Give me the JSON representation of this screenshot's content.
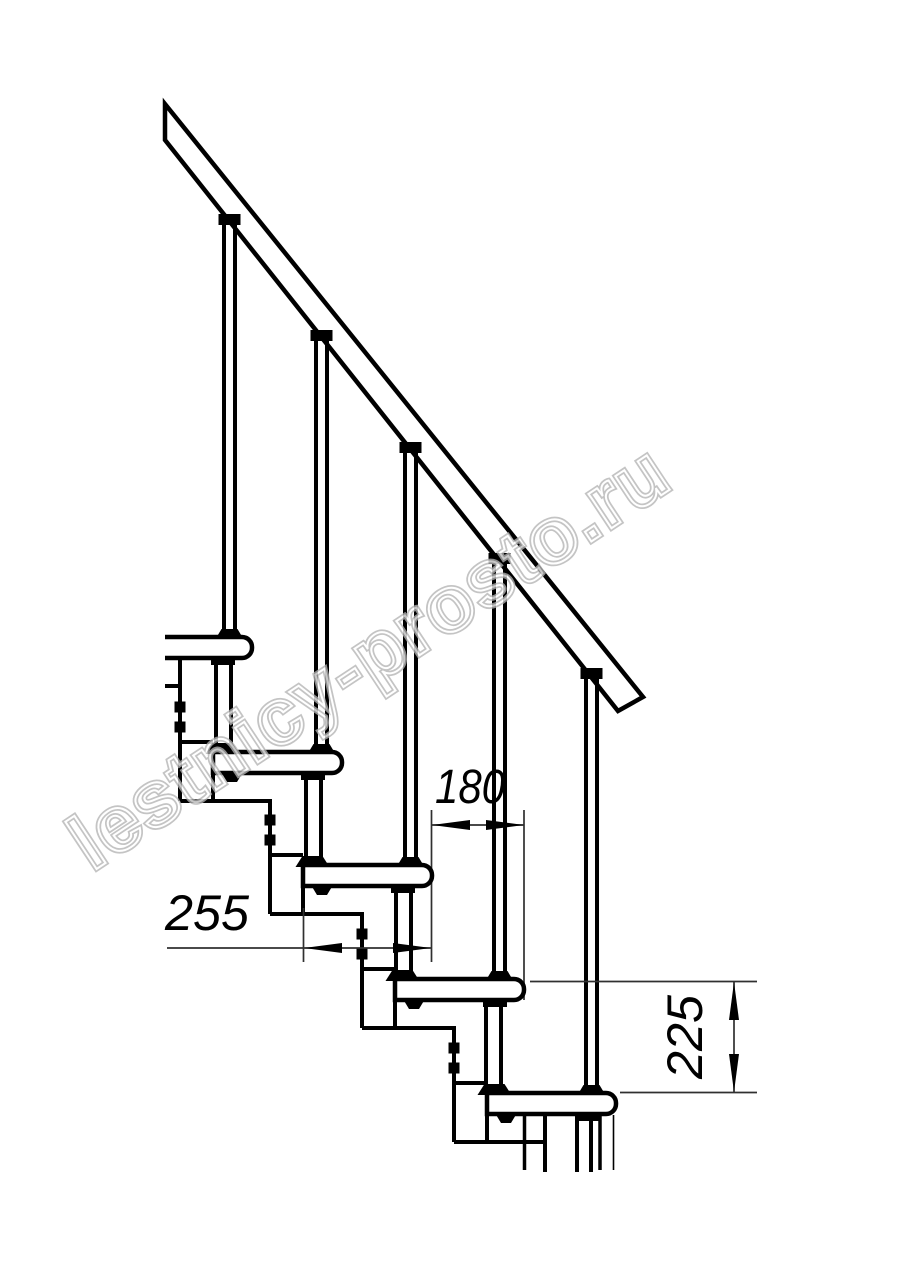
{
  "watermark": "lestnicy-prosto.ru",
  "dimensions": {
    "overlap": "180",
    "depth": "255",
    "rise": "225"
  },
  "colors": {
    "line": "#000000",
    "background": "#ffffff",
    "watermark_outline": "#b4b4b4"
  }
}
